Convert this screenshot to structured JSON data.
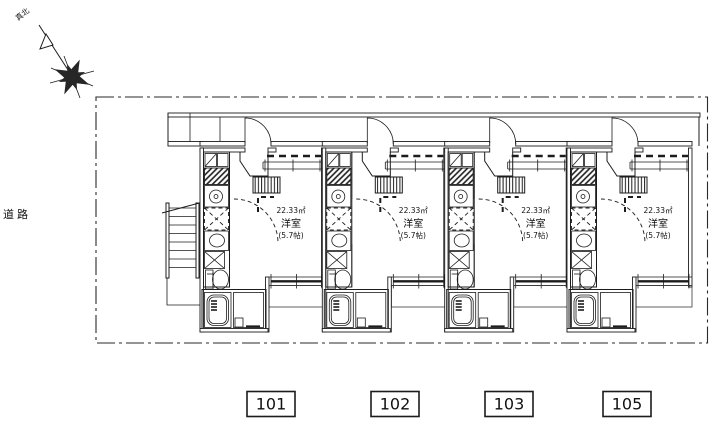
{
  "colors": {
    "line": "#1c1c1c",
    "paper": "#ffffff"
  },
  "compass": {
    "north_label": "真北"
  },
  "site": {
    "road_label": "道路"
  },
  "units": [
    {
      "number": "101",
      "room": {
        "area": "22.33㎡",
        "type": "洋室",
        "tatami": "(5.7帖)"
      }
    },
    {
      "number": "102",
      "room": {
        "area": "22.33㎡",
        "type": "洋室",
        "tatami": "(5.7帖)"
      }
    },
    {
      "number": "103",
      "room": {
        "area": "22.33㎡",
        "type": "洋室",
        "tatami": "(5.7帖)"
      }
    },
    {
      "number": "105",
      "room": {
        "area": "22.33㎡",
        "type": "洋室",
        "tatami": "(5.7帖)"
      }
    }
  ]
}
